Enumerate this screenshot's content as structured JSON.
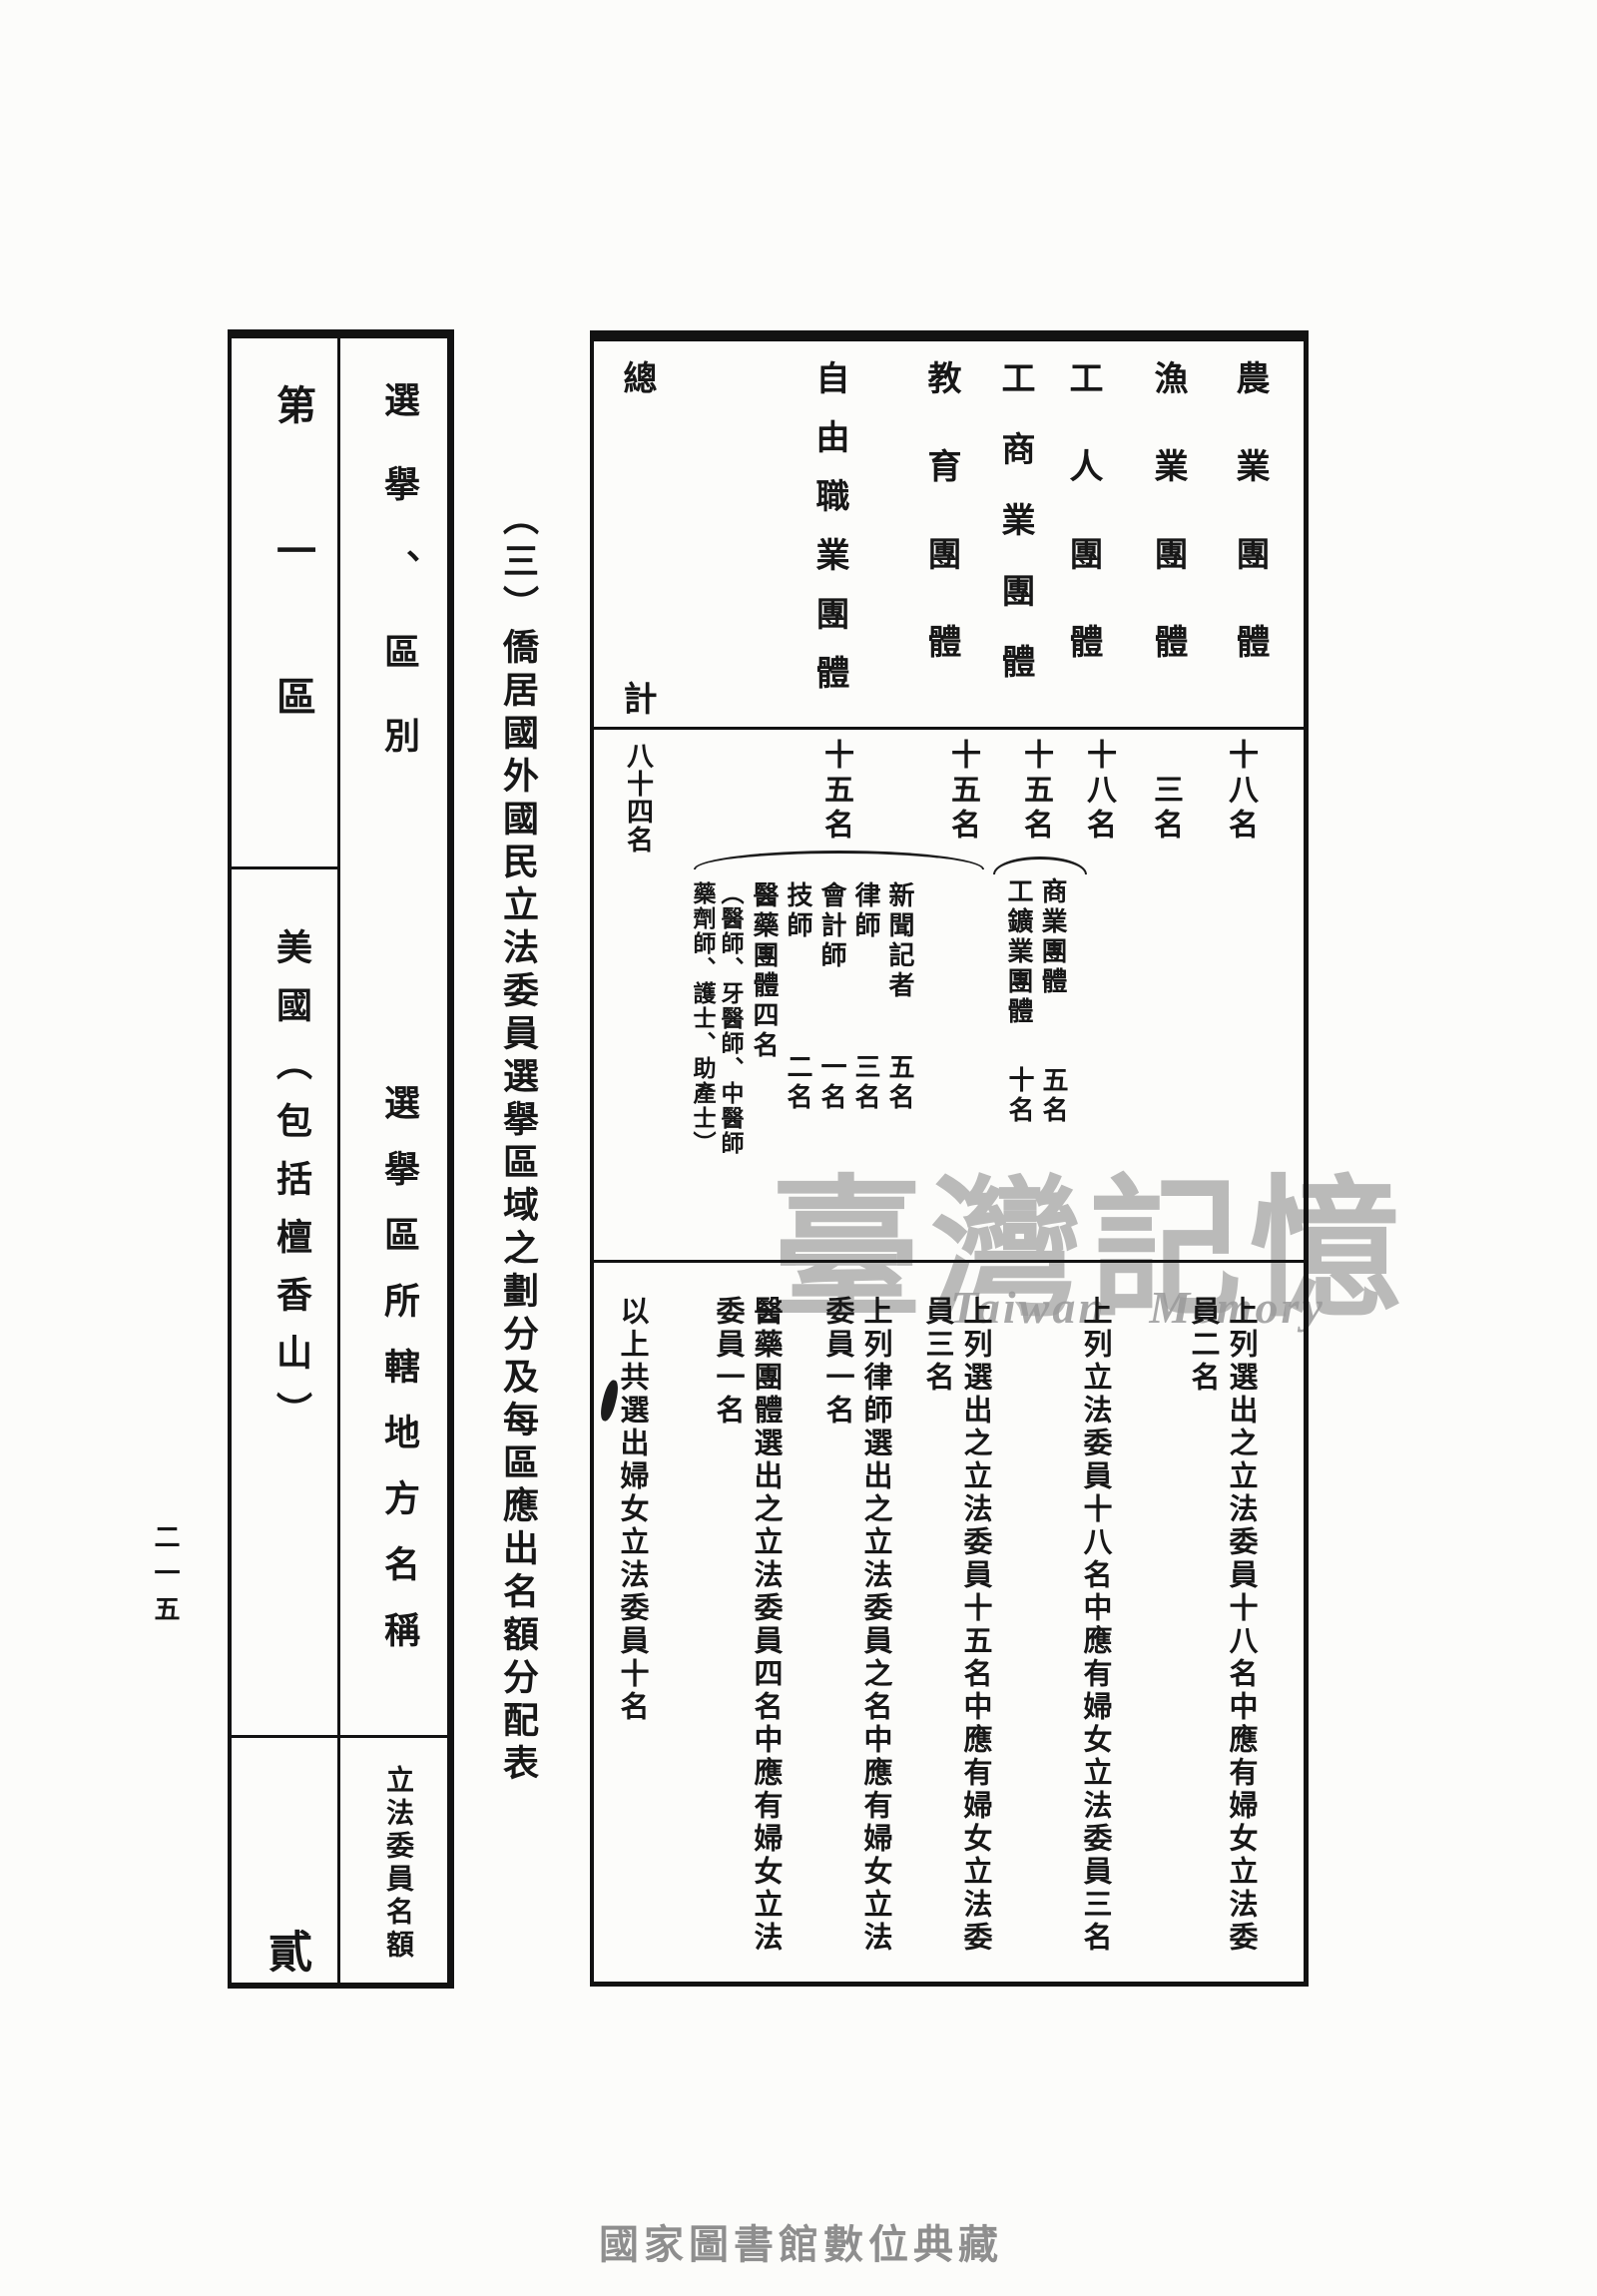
{
  "page": {
    "page_number": "二一五",
    "footer": "國家圖書館數位典藏"
  },
  "watermark": {
    "cjk": "臺灣記憶",
    "latin": "Taiwan Memory"
  },
  "section_title": "（三）僑居國外國民立法委員選擧區域之劃分及每區應出名額分配表",
  "district_table": {
    "rows": [
      {
        "label": "選擧、區別",
        "value": "第一區"
      },
      {
        "label": "選擧區所轄地方名稱",
        "value": "美國（包括檀香山）"
      },
      {
        "label": "立法委員名額",
        "value": "貳"
      }
    ]
  },
  "quota_table": {
    "columns": [
      {
        "header": "農業團體",
        "quota": "十八名",
        "note": "上列選出之立法委員十八名中應有婦女立法委員二名"
      },
      {
        "header": "漁業團體",
        "quota": "三名",
        "note": ""
      },
      {
        "header": "工人團體",
        "quota": "十八名",
        "note": "上列立法委員十八名中應有婦女立法委員三名"
      },
      {
        "header": "工商業團體",
        "quota": "十五名",
        "subgroups": [
          {
            "name": "商業團體",
            "count": "五名"
          },
          {
            "name": "工鑛業團體",
            "count": "十名"
          }
        ],
        "note": ""
      },
      {
        "header": "教育團體",
        "quota": "十五名",
        "note": "上列選出之立法委員十五名中應有婦女立法委員三名"
      },
      {
        "header": "自由職業團體",
        "quota": "十五名",
        "subgroups": [
          {
            "name": "新聞記者",
            "count": "五名"
          },
          {
            "name": "律師",
            "count": "三名"
          },
          {
            "name": "會計師",
            "count": "一名"
          },
          {
            "name": "技師",
            "count": "二名"
          },
          {
            "name": "醫藥團體四名",
            "count": ""
          }
        ],
        "medical_members_col1": "︵醫師、牙醫師、中醫師",
        "medical_members_col2": "藥劑師、護士、助產士︶",
        "note_lawyers": "上列律師選出之立法委員之名中應有婦女立法委員一名",
        "note_medical": "醫藥團體選出之立法委員四名中應有婦女立法委員一名"
      },
      {
        "header": "總計",
        "quota": "八十四名",
        "note": "以上共選出婦女立法委員十名"
      }
    ]
  }
}
